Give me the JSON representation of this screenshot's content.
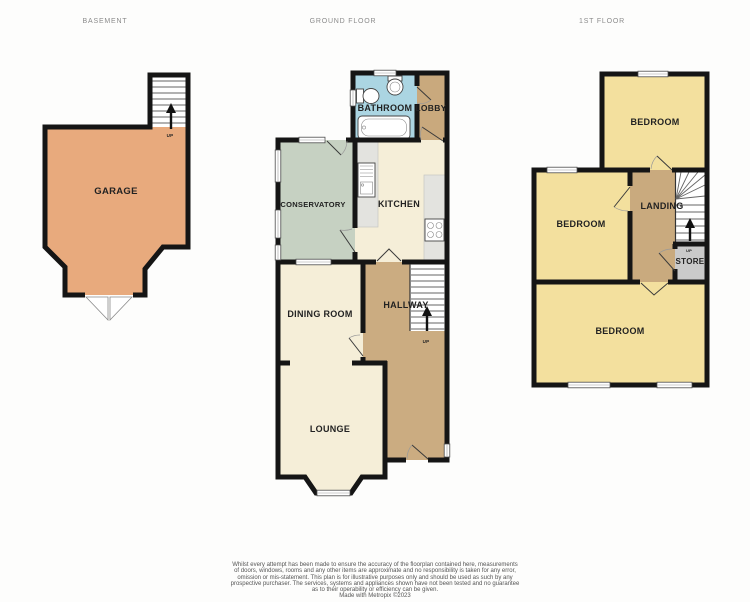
{
  "headers": {
    "basement": "BASEMENT",
    "ground": "GROUND FLOOR",
    "first": "1ST FLOOR"
  },
  "basement": {
    "garage": "GARAGE",
    "up": "UP"
  },
  "ground": {
    "bathroom": "BATHROOM",
    "lobby": "LOBBY",
    "conservatory": "CONSERVATORY",
    "kitchen": "KITCHEN",
    "dining": "DINING ROOM",
    "hallway": "HALLWAY",
    "lounge": "LOUNGE",
    "up": "UP"
  },
  "first": {
    "bedroom_top": "BEDROOM",
    "bedroom_mid": "BEDROOM",
    "bedroom_bottom": "BEDROOM",
    "landing": "LANDING",
    "store": "STORE",
    "up": "UP"
  },
  "disclaimer": {
    "lines": [
      "Whilst every attempt has been made to ensure the accuracy of the floorplan contained here, measurements",
      "of doors, windows, rooms and any other items are approximate and no responsibility is taken for any error,",
      "omission or mis-statement. This plan is for illustrative purposes only and should be used as such by any",
      "prospective purchaser. The services, systems and appliances shown have not been tested and no guarantee",
      "as to their operability or efficiency can be given.",
      "Made with Metropix ©2023"
    ]
  },
  "colors": {
    "wall": "#151515",
    "garage": "#e8aa7d",
    "bathroom": "#abd5e2",
    "lobby": "#c9a97d",
    "conservatory": "#c6d1c2",
    "cream": "#f5eed8",
    "hallway": "#cbac81",
    "counter": "#e3e3df",
    "bedroom": "#f3e09e",
    "landing": "#c9aa7e",
    "store": "#cacaca",
    "label": "#222222",
    "floor_label": "#8b8b8b",
    "disclaimer": "#555555"
  }
}
